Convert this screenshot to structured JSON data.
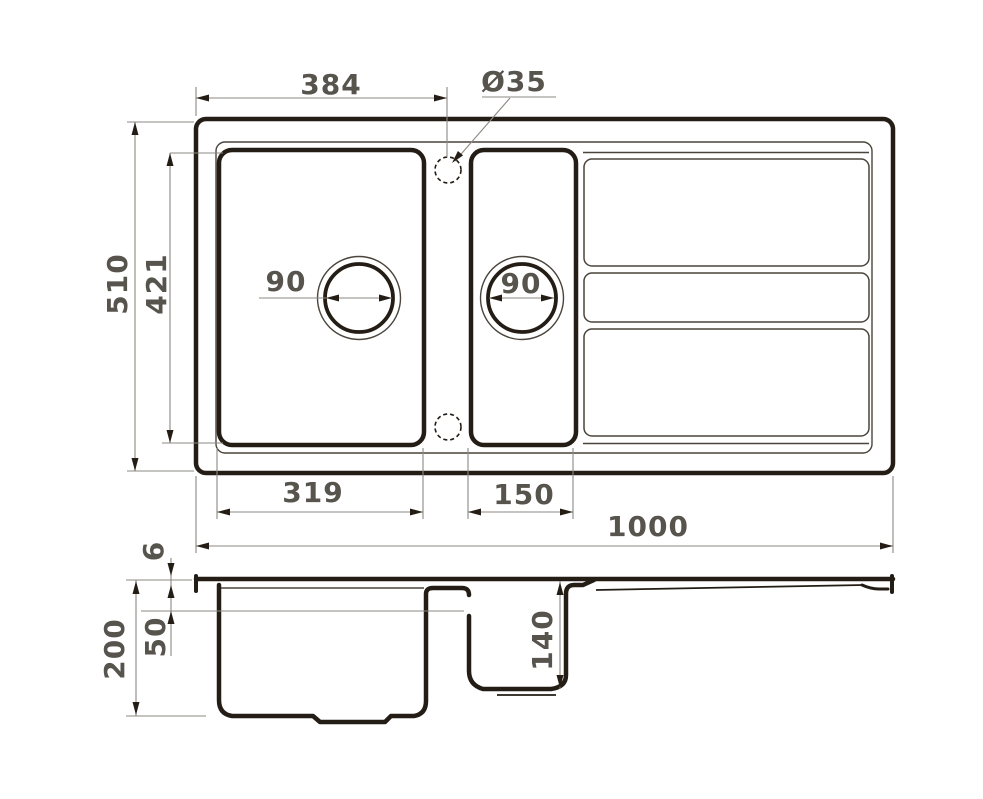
{
  "diagram": {
    "type": "technical-drawing-kitchen-sink",
    "colors": {
      "outline": "#241d15",
      "dimension_line": "#8d8880",
      "label_text": "#57534d",
      "background": "#ffffff"
    },
    "top_view": {
      "tap_hole_offset": "384",
      "tap_hole_diameter": "Ø35",
      "overall_depth": "510",
      "bowls_depth": "421",
      "main_drain_diameter": "90",
      "small_drain_diameter": "90",
      "main_bowl_width": "319",
      "small_bowl_width": "150",
      "overall_width": "1000"
    },
    "section_view": {
      "rim_thickness": "6",
      "overall_height": "200",
      "upper_level": "50",
      "small_bowl_depth": "140"
    }
  }
}
